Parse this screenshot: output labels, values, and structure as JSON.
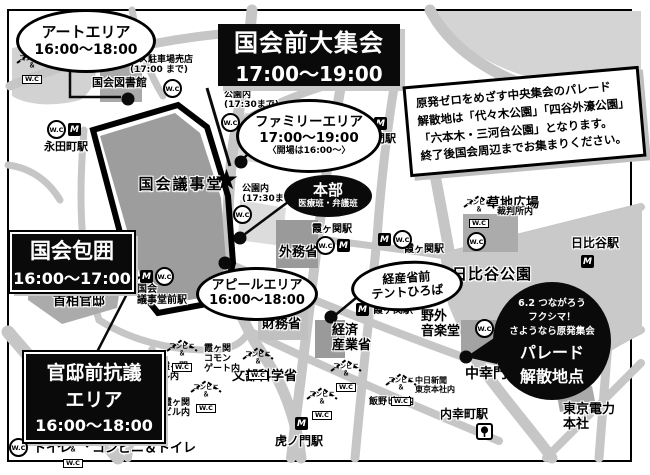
{
  "event_areas": {
    "art": {
      "name": "アートエリア",
      "time": "16:00～18:00"
    },
    "main_rally": {
      "name": "国会前大集会",
      "time": "17:00～19:00"
    },
    "family": {
      "name": "ファミリーエリア",
      "time": "17:00～19:00",
      "note": "〈開場は16:00～〉"
    },
    "headquarters": {
      "name": "本部",
      "sub": "医療班・弁護班"
    },
    "surround": {
      "name": "国会包囲",
      "time": "16:00～17:00"
    },
    "appeal": {
      "name": "アピールエリア",
      "time": "16:00～18:00"
    },
    "tent": {
      "line1": "経産省前",
      "line2": "テントひろば"
    },
    "kantei": {
      "line1": "官邸前抗議",
      "line2": "エリア",
      "time": "16:00～18:00"
    },
    "parade": {
      "line1": "6.2 つながろう",
      "line2": "フクシマ！",
      "line3": "さようなら原発集会",
      "line4": "パレード",
      "line5": "解散地点"
    }
  },
  "notice": {
    "line1": "原発ゼロをめざす中央集会のパレード",
    "line2": "解散地は「代々木公園」「四谷外濠公園」",
    "line3": "「六本木・三河台公園」となります。",
    "line4": "終了後国会周辺までお集まりください。"
  },
  "landmarks": {
    "library": "国会図書館",
    "diet": "国会議事堂",
    "kantei": "首相官邸",
    "mofa": "外務省",
    "mof": "財務省",
    "meti1": "経済",
    "meti2": "産業省",
    "mext": "文部科学省",
    "ongakudo1": "野外",
    "ongakudo2": "音楽堂",
    "hibiya_park": "日比谷公園",
    "kusachi": "草地広場",
    "tepco1": "東京電力",
    "tepco2": "本社",
    "nakasaiwaimon": "中幸門"
  },
  "stations": {
    "nagatacho": "永田町駅",
    "kokkai1": "国会",
    "kokkai2": "議事堂前駅",
    "sakuradamon": "桜田門駅",
    "kasumigaseki": "霞ヶ関駅",
    "hibiya": "日比谷駅",
    "toranomon": "虎ノ門駅",
    "uchisaiwaicho": "内幸町駅"
  },
  "facilities": {
    "bus1": "バス駐車場売店",
    "bus2": "(17:00 まで)",
    "park_in": "公園内",
    "park_until": "(17:30まで)",
    "court": "裁判所内",
    "shinkasumi1": "新霞ヶ関",
    "shinkasumi2": "ビル内",
    "common1": "霞ヶ関",
    "common2": "コモン",
    "common3": "ゲート内",
    "kasumibldg1": "霞ヶ関",
    "kasumibldg2": "ビル内",
    "iino": "飯野ビル内",
    "chunichi1": "中日新聞",
    "chunichi2": "東京本社内"
  },
  "legend": {
    "wc": "トイレ",
    "conv": "コンビニ＆トイレ"
  },
  "icons": {
    "wc": "W.C",
    "metro": "M",
    "shop_top": "コンビニ",
    "shop_amp": "＆",
    "shop_wc": "W.C"
  },
  "colors": {
    "road": "#c6c6c6",
    "building": "#9d9d9d",
    "park": "#c9c9c9",
    "accent": "#0a0a0a"
  }
}
